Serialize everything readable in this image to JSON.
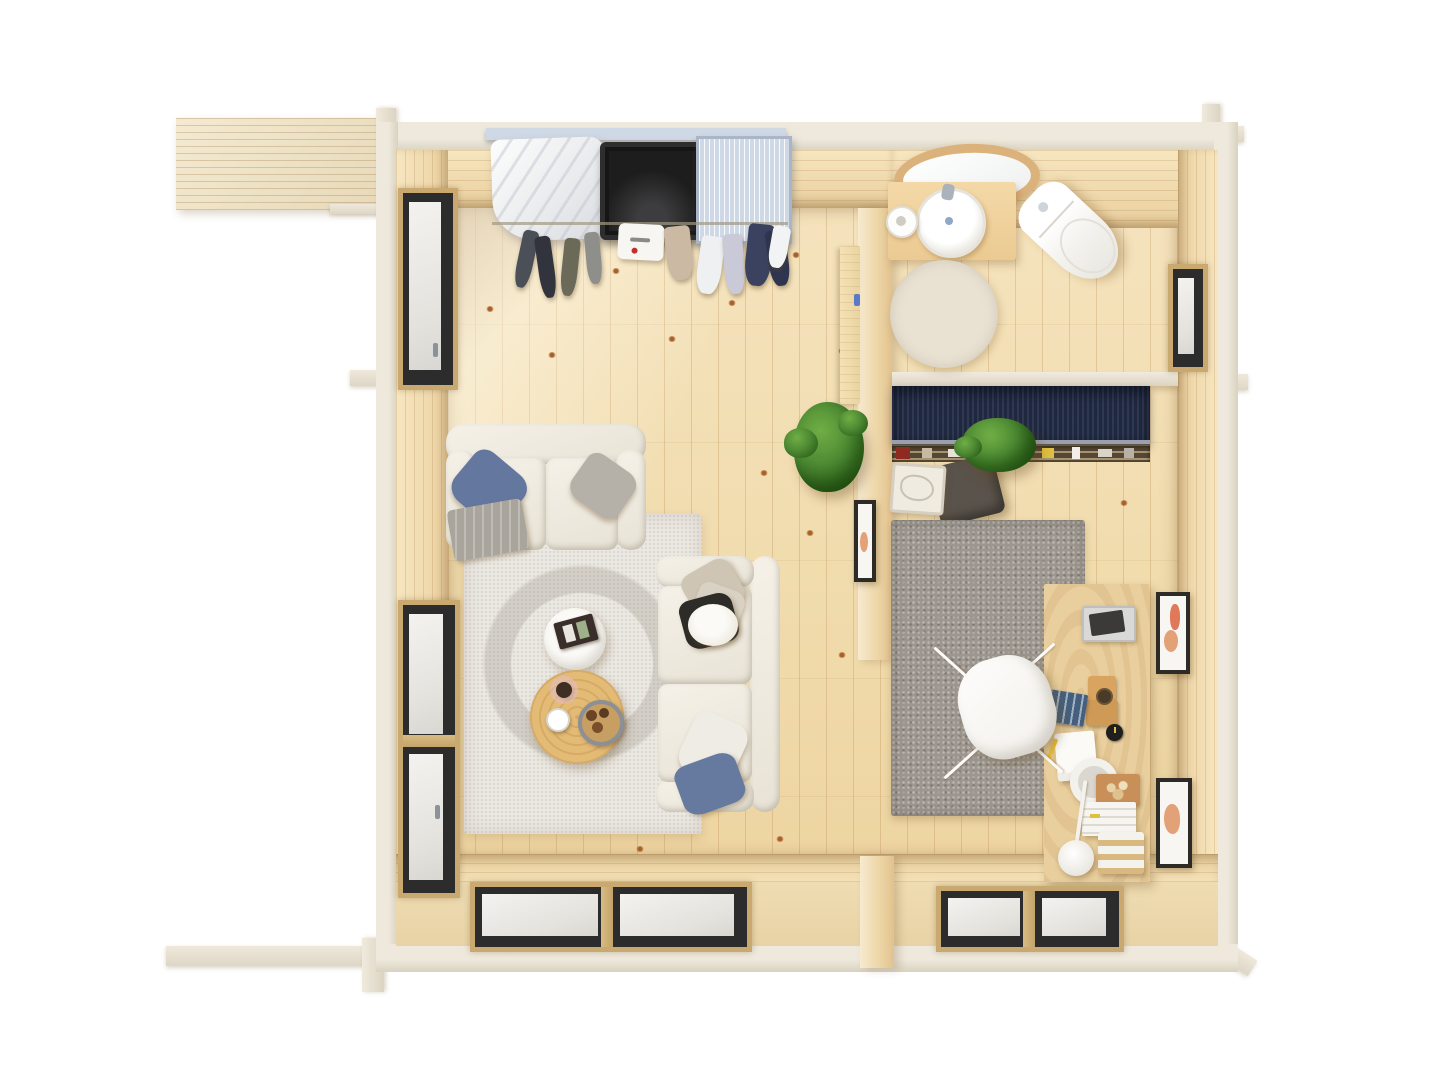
{
  "scene": {
    "type": "3d-floor-plan-top-view",
    "subject": "bird's-eye render of a furnished one-bedroom log cabin",
    "background": "#ffffff"
  },
  "palette": {
    "outer_beam": "#ebe6d9",
    "wall_wood": "#f0dcb2",
    "floor_base": "#f2dfb6",
    "navy_unit": "#242e48",
    "shelf_dark": "#554732",
    "office_rug": "#9c968e",
    "living_rug": "#ece9e3",
    "bath_rug": "#e9e1d2",
    "sofa": "#f1ede3",
    "pillow_blue": "#64779f",
    "pillow_blue_2": "#66799f",
    "pillow_gray": "#b5b0a8",
    "throw_gray": "#a9a59d",
    "pillow_beige": "#cfc5b4",
    "pillow_beige_2": "#d9d2c4",
    "pillow_white": "#efece6",
    "dark_item": "#2e2c28",
    "table_white": "#fbfaf7",
    "table_wood": "#e3bb75",
    "plant_green": "#4d8a33",
    "desk_wood": "#e9cf9d",
    "vanity_wood": "#ecca92",
    "chair_white": "#f7f5f1",
    "ottoman": "#5a534b",
    "tray_white": "#f0ebe1",
    "porcelain": "#ffffff",
    "window_sash": "#2c2c2c",
    "window_wood": "#c9a96f",
    "metal_rack": "#cfd9e6",
    "black_box": "#161616",
    "art_terracotta": "#e0795a",
    "art_peach": "#e2a176",
    "mirror_wood": "#dcb27c",
    "handle_blue": "#5b79c9",
    "magazine_navy": "#44607e",
    "magazine_dark": "#3a2e2a"
  },
  "rooms": [
    {
      "name": "wardrobe-nook",
      "items": [
        "wall-mounted-rail",
        "garment-cover",
        "hanging-organizer",
        "wire-basket-rack",
        "hanging-clothes"
      ]
    },
    {
      "name": "living-room",
      "items": [
        "two-seat-sofa",
        "chaise-sofa",
        "area-rug",
        "white-round-coffee-table",
        "wooden-round-coffee-table",
        "magazine",
        "serving-plate",
        "coffee-cup",
        "dried-flowers",
        "potted-plant"
      ]
    },
    {
      "name": "bathroom",
      "items": [
        "wall-mirror",
        "wood-vanity",
        "round-basin",
        "faucet",
        "toilet",
        "toilet-paper-roll",
        "round-rug",
        "open-door",
        "side-window"
      ]
    },
    {
      "name": "home-office",
      "items": [
        "navy-daybed",
        "book-ledge",
        "trailing-plant",
        "dark-pouf",
        "storage-basket",
        "gray-rug",
        "wooden-desk",
        "shell-chair",
        "desk-lamp",
        "letter-trays",
        "notepads",
        "wall-art-top",
        "wall-art-bottom"
      ]
    }
  ],
  "openings": {
    "left_wall_windows": 2,
    "rear_glazed_doors": 2,
    "bathroom_side_window": 1,
    "roof_overhang": true
  }
}
